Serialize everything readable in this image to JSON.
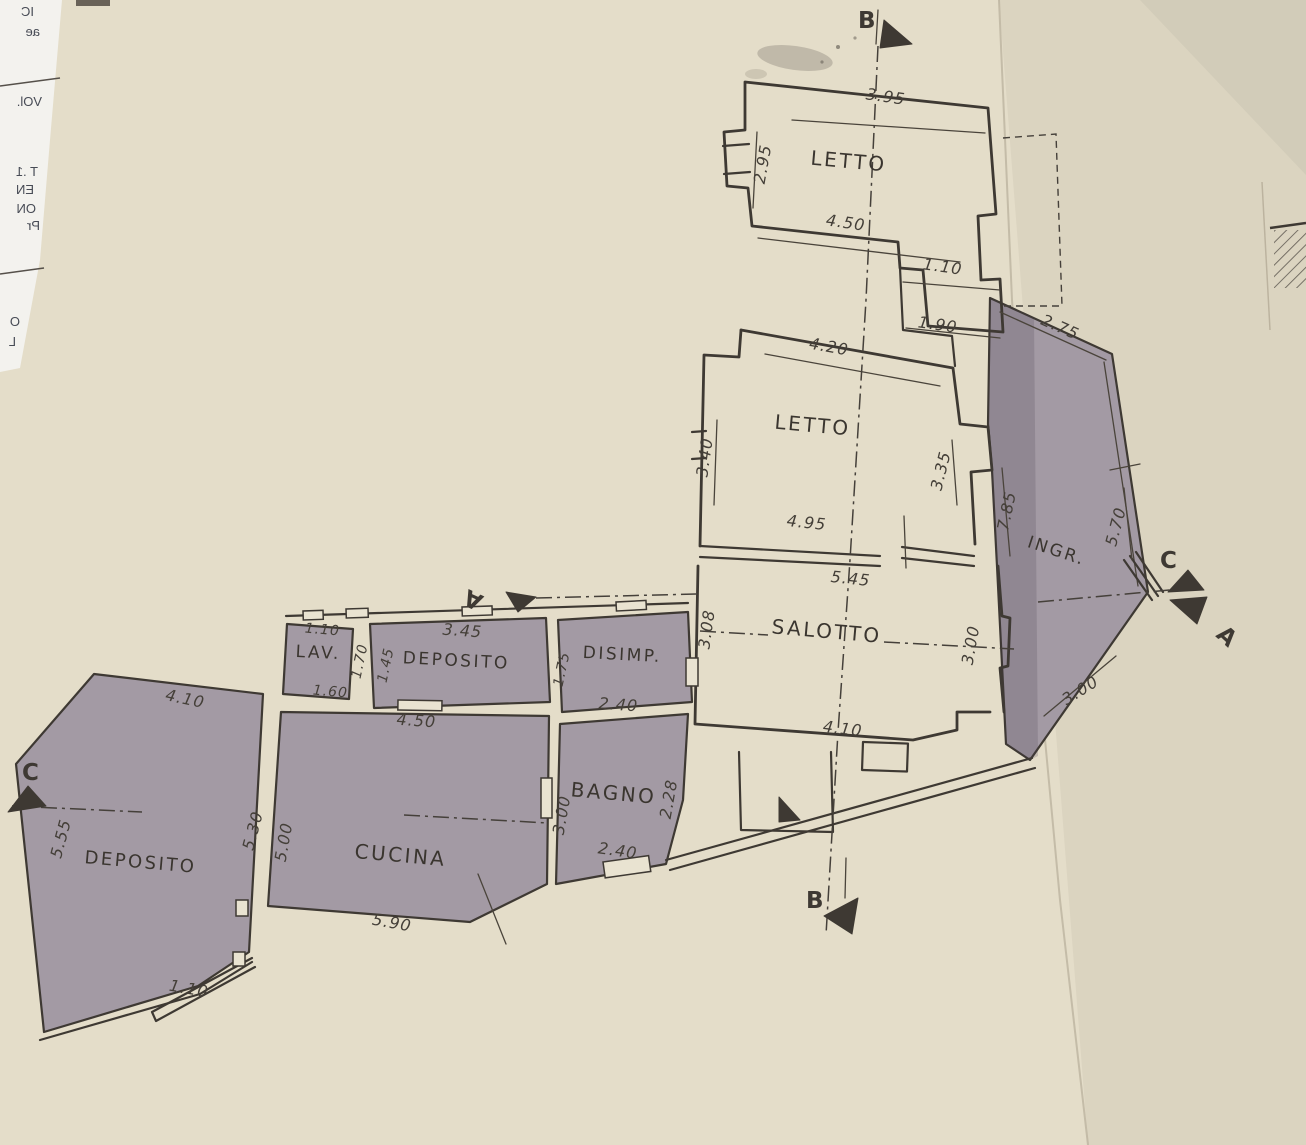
{
  "colors": {
    "paper": "#e4ddc9",
    "margin_strip": "#f3f2ee",
    "ink": "#3e3933",
    "dimension_ink": "#443f38",
    "shaded_room_fill": "#a39aa4",
    "entrance_fill": "#948b96"
  },
  "rooms": [
    {
      "id": "letto-top",
      "label": "LETTO"
    },
    {
      "id": "letto-mid",
      "label": "LETTO"
    },
    {
      "id": "salotto",
      "label": "SALOTTO"
    },
    {
      "id": "ingresso",
      "label": "INGR."
    },
    {
      "id": "lavanderia",
      "label": "LAV."
    },
    {
      "id": "deposito-small",
      "label": "DEPOSITO"
    },
    {
      "id": "disimpegno",
      "label": "DISIMP."
    },
    {
      "id": "bagno",
      "label": "BAGNO"
    },
    {
      "id": "cucina",
      "label": "CUCINA"
    },
    {
      "id": "deposito-large",
      "label": "DEPOSITO"
    }
  ],
  "dims": [
    {
      "id": "letto-top-width-top",
      "v": "3.95"
    },
    {
      "id": "letto-top-left",
      "v": "2.95"
    },
    {
      "id": "letto-top-width-bottom",
      "v": "4.50"
    },
    {
      "id": "letto-top-step-right",
      "v": "1.10"
    },
    {
      "id": "connector-width",
      "v": "1.90"
    },
    {
      "id": "ingresso-top",
      "v": "2.75"
    },
    {
      "id": "letto-mid-top",
      "v": "4.20"
    },
    {
      "id": "letto-mid-left",
      "v": "3.40"
    },
    {
      "id": "letto-mid-right",
      "v": "3.35"
    },
    {
      "id": "ingresso-left",
      "v": "7.85"
    },
    {
      "id": "ingresso-right",
      "v": "5.70"
    },
    {
      "id": "letto-mid-bottom",
      "v": "4.95"
    },
    {
      "id": "salotto-top",
      "v": "5.45"
    },
    {
      "id": "salotto-left",
      "v": "3.08"
    },
    {
      "id": "salotto-right",
      "v": "3.00"
    },
    {
      "id": "ingresso-bottom",
      "v": "3.00"
    },
    {
      "id": "salotto-bottom",
      "v": "4.10"
    },
    {
      "id": "lav-top",
      "v": "1.10"
    },
    {
      "id": "lav-right",
      "v": "1.70"
    },
    {
      "id": "lav-bottom",
      "v": "1.60"
    },
    {
      "id": "deposito-small-top",
      "v": "3.45"
    },
    {
      "id": "deposito-small-left",
      "v": "1.45"
    },
    {
      "id": "deposito-small-bottom",
      "v": "4.50"
    },
    {
      "id": "disimpegno-left",
      "v": "1.75"
    },
    {
      "id": "disimpegno-bottom",
      "v": "2.40"
    },
    {
      "id": "bagno-left",
      "v": "3.00"
    },
    {
      "id": "bagno-right",
      "v": "2.28"
    },
    {
      "id": "bagno-bottom",
      "v": "2.40"
    },
    {
      "id": "cucina-top",
      "v": "4.50"
    },
    {
      "id": "cucina-left",
      "v": "5.00"
    },
    {
      "id": "cucina-bottom",
      "v": "5.90"
    },
    {
      "id": "deposito-large-top",
      "v": "4.10"
    },
    {
      "id": "deposito-large-left",
      "v": "5.55"
    },
    {
      "id": "deposito-large-right",
      "v": "5.30"
    },
    {
      "id": "deposito-large-stub",
      "v": "1.10"
    }
  ],
  "markers": {
    "b_top": "B",
    "b_bottom": "B",
    "c_right": "C",
    "a_right": "A",
    "c_left": "C",
    "a_left": "A"
  },
  "margin_fragments": [
    {
      "v": "IC"
    },
    {
      "v": "ae"
    },
    {
      "v": "VOl."
    },
    {
      "v": "T .1"
    },
    {
      "v": "EN"
    },
    {
      "v": "ON"
    },
    {
      "v": "Pr"
    },
    {
      "v": "O"
    },
    {
      "v": "L"
    }
  ]
}
